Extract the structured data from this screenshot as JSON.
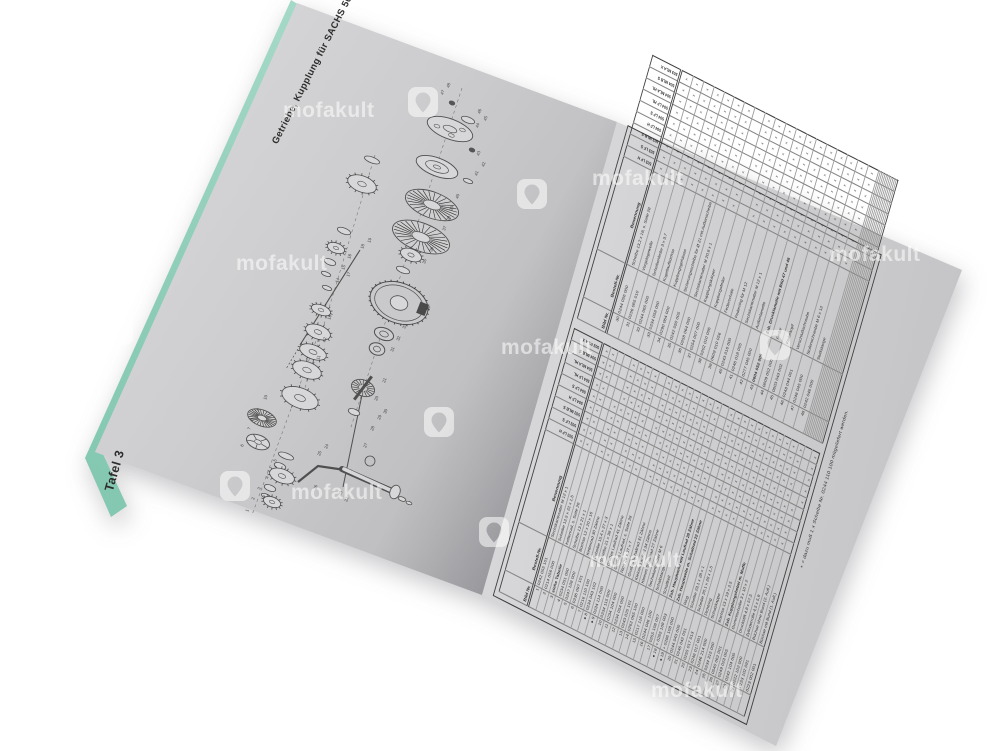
{
  "watermark": {
    "text": "mofakult",
    "icon": "location-pin-icon",
    "color": "#ffffff"
  },
  "left_page": {
    "title": "Getriebe, Kupplung für SACHS 50/4",
    "plate_label": "Tafel 3"
  },
  "diagram": {
    "kind": "exploded-parts-diagram",
    "labels": [
      "47",
      "48",
      "46",
      "45",
      "44",
      "43",
      "42",
      "41",
      "40",
      "39",
      "38",
      "37",
      "36",
      "35",
      "34",
      "33",
      "32",
      "31",
      "30",
      "29",
      "28",
      "27",
      "26",
      "25",
      "24",
      "23",
      "22",
      "21",
      "20",
      "19",
      "18",
      "17",
      "16",
      "15",
      "14",
      "13",
      "12",
      "11",
      "10",
      "9",
      "8",
      "7",
      "6",
      "5",
      "4",
      "3",
      "2",
      "1"
    ]
  },
  "right_page": {
    "footnote": "+ = dazu muß 1 x Scheibe Nr. 0244 110 100 mitgeliefert werden.",
    "tables": {
      "headers": {
        "bild": "Bild Nr.",
        "bestell": "Bestell-Nr.",
        "benennung": "Benennung"
      },
      "models": [
        "503 LF H",
        "503 LF S",
        "503 MLB S",
        "504 LF H",
        "504 LF S",
        "504 LF HL",
        "504 MLA HL",
        "504 MLB S",
        "503 MLA X"
      ],
      "left_rows": [
        [
          "1",
          "0242 055 101",
          "Sechskantmutter M 12 x 1",
          "xxxxxxxxx",
          ""
        ],
        [
          "2",
          "0214 056 000",
          "Scheibe 12,5 x 22 x 1,5",
          "xxxxxxxxx",
          ""
        ],
        [
          "3",
          "siehe Tabelle",
          "Kettenrad, s. Seite 26",
          ".........",
          "b"
        ],
        [
          "4",
          "0234 051 000",
          "Scheibe 13 x 21 x 1",
          "xxxxx....",
          ""
        ],
        [
          "5",
          "0247 108 000",
          "Büchse 12 x 20 x 16",
          "xxxxxxxxx",
          ""
        ],
        [
          "6",
          "0236 097 101",
          "Kettenrad 30 Zähne",
          "....xxxxx",
          ""
        ],
        [
          "7",
          "0216 110 100",
          "Scheibe 15,4 x 27 x 3",
          "xxxxxxxxx",
          ""
        ],
        [
          "8",
          "0234 043 102",
          "Scheibe 21 x 38 x 1",
          "xxxxxxxxx",
          "d"
        ],
        [
          "9",
          "0234 114 000",
          "Großes Laufrad 41 Zähne",
          "xxxx.....",
          "d"
        ],
        [
          "10",
          "0234 115 000",
          "Großes Laufrad, s. Seite 28",
          "....xxxxx",
          ""
        ],
        [
          "11",
          "0234 104 000",
          "Ring 29 x 37 x 7",
          "xxxxxxxxx",
          ""
        ],
        [
          "12",
          "0234 054 000",
          "Großes Schaltrad 31 Zähne",
          "xxxxxxxxx",
          ""
        ],
        [
          "13",
          "0243 025 101",
          "Kleines Laufrad 34 Zähne",
          "xxxxxxxxx",
          ""
        ],
        [
          "14",
          "0262 065 100",
          "Kleines Schaltrad 27 Zähne",
          "xxxxxxxxx",
          ""
        ],
        [
          "15",
          "0217 116 000",
          "Sechskantmutter M 6",
          "xxxxxxxxx",
          ""
        ],
        [
          "16",
          "0244 046 100",
          "Schaltstange",
          "xxxxxxxxx",
          ""
        ],
        [
          "17",
          "0255 108 007",
          "Schaltkeil",
          "xxxxxxxxx",
          ""
        ],
        [
          "18",
          "+ 0265 108 003",
          "Zsb. Hauptwelle mit Laufrad 28 Zähne",
          "xxxx.....",
          "d"
        ],
        [
          "19",
          "+ 0286 108 000",
          "Zsb. Hauptwelle m. Schaltrad 22 Zähne",
          "....xxxxx",
          "d"
        ],
        [
          "20",
          "0244 043 000",
          "Ring",
          "xxxxxxxxx",
          ""
        ],
        [
          "21",
          "0246 042 051",
          "Scheibe 23,1 x 28 x 1",
          "xxxxxxxxx",
          ""
        ],
        [
          "22",
          "0255 017 013",
          "Scheibe 20,1 x 28 x 1,5",
          "xxxxxxxxx",
          ""
        ],
        [
          "23",
          "0246 017 001",
          "Dichtring",
          "xxxxxxxxx",
          ""
        ],
        [
          "24",
          "0246 214 000",
          "Schutzkappe",
          "xxxxxxxxx",
          ""
        ],
        [
          "25",
          "0234 315 000",
          "Büchse 13 x 19 x 2,5",
          "xxxxxxxxx",
          ""
        ],
        [
          "26",
          "0540 062 001",
          "Zsb. Kupplungshebel m. Muffe",
          "xxxxxxxxx",
          ""
        ],
        [
          "27",
          "0249 023 005",
          "Gummischeibe 3 x 10 x 2",
          "xxxxxxxxx",
          ""
        ],
        [
          "28",
          "0242 104 000",
          "Druckstift 4,8 x 57,5",
          "xxxxxxxxx",
          ""
        ],
        [
          "29",
          "0222 102 000",
          "Zylinderrolle 4,5 x 5,9",
          "xxxxxxxxx",
          ""
        ],
        [
          "",
          "0223 102 091",
          "Büchse ohne Bund (2. Aufl.)",
          "xxxx.....",
          ""
        ],
        [
          "",
          "0223 002 001",
          "Büchse mit Bund (1. Aufl.)",
          "....xxxxx",
          ""
        ]
      ],
      "right_rows": [
        [
          "30",
          "0244 056 000",
          "Scheibe 13,2 x 18, s. Seite 28",
          "xxxxxxxxx",
          ""
        ],
        [
          "31",
          "0256 065 010",
          "Vorgelegewelle",
          "xxxxxxxxx",
          ""
        ],
        [
          "32",
          "0244 065 000",
          "Scheibenfeder 3 x 3,7",
          "xxxxxxxxx",
          ""
        ],
        [
          "33",
          "0234 058 000",
          "Kugellaufbüchse",
          "xxxxxxxxx",
          ""
        ],
        [
          "34",
          "0290 064 000",
          "Kupplungsgehäuse",
          "xxxxxxxxx",
          ""
        ],
        [
          "35",
          "0242 050 005",
          "Sicherungsscheibe für Ø 21 mit Außenscheibe",
          "xxxxxxxxx",
          ""
        ],
        [
          "36",
          "0258 064 000",
          "Sechskantmutter M 20,8 x 1",
          "xxxxxxxxx",
          ""
        ],
        [
          "37",
          "0254 007 000",
          "Kupplungskörper",
          "xxxx.....",
          ""
        ],
        [
          "38",
          "0202 010 006",
          "Kupplungsfeder",
          "....xxxxx",
          ""
        ],
        [
          "39",
          "0609 010 056",
          "Federschale",
          "xxxxxxxxx",
          ""
        ],
        [
          "40",
          "0243 016 000",
          "Federring für M 12",
          "xxxxxxxxx",
          ""
        ],
        [
          "41",
          "0246 018 005",
          "Sechskantmutter M 12 x 1",
          "xxxxxxxxx",
          ""
        ],
        [
          "42",
          "0277 045 000",
          "Außenlamelle",
          "xxxxxxxxx",
          ""
        ],
        [
          "43",
          "0604 052 000",
          "Zsb. Drucklamelle mit Bild 47 und 48",
          "xxxxxxxxx",
          "b"
        ],
        [
          "44",
          "0609 052 000",
          "Feder",
          "xxxxxxxxx",
          ""
        ],
        [
          "45",
          "0603 043 002",
          "Federkopf",
          "xxxxxxxxx",
          ""
        ],
        [
          "46",
          "0248 044 001",
          "Verschlußschraube",
          "xxxxxxxxx",
          ""
        ],
        [
          "47",
          "0248 045 000",
          "Stufenschraube M 6 x 12",
          "xxxxxxxxx",
          ""
        ],
        [
          "48",
          "0242 046 000",
          "Stoßstange",
          "xxxxxxxxx",
          ""
        ]
      ]
    }
  }
}
